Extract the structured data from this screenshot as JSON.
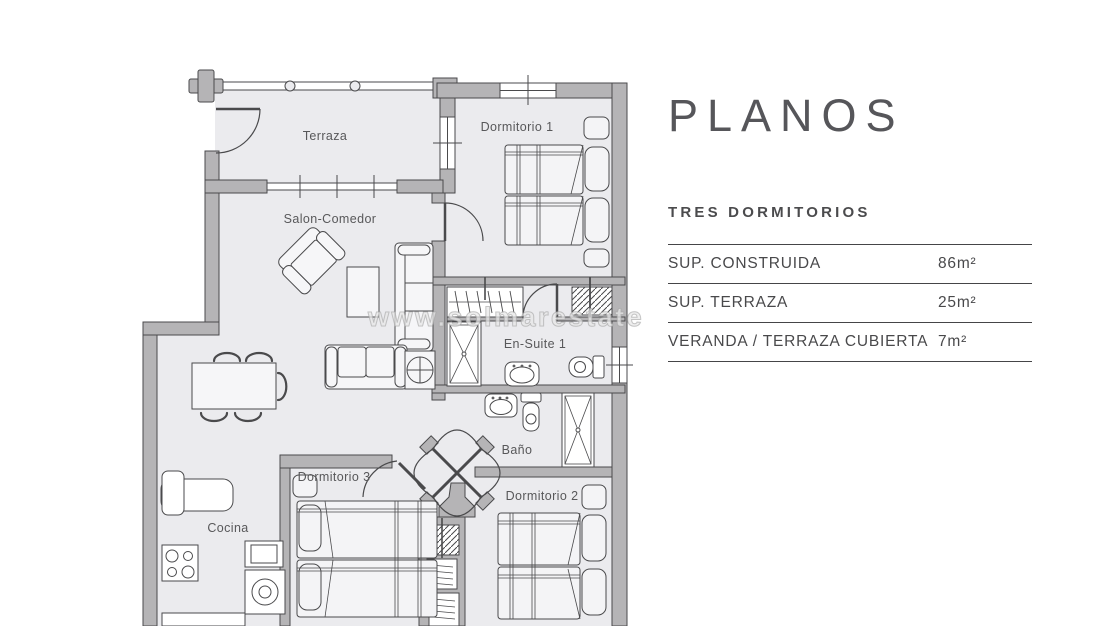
{
  "panel": {
    "title": "PLANOS",
    "subtitle": "TRES DORMITORIOS",
    "rows": [
      {
        "label": "SUP.  CONSTRUIDA",
        "value": "86m²"
      },
      {
        "label": "SUP. TERRAZA",
        "value": "25m²"
      },
      {
        "label": "VERANDA / TERRAZA CUBIERTA",
        "value": "7m²"
      }
    ]
  },
  "floorplan": {
    "watermark": "www.solmarestate",
    "rooms": {
      "terraza": "Terraza",
      "dormitorio1": "Dormitorio 1",
      "salon": "Salon-Comedor",
      "ensuite": "En-Suite 1",
      "bano": "Baño",
      "dormitorio3": "Dormitorio 3",
      "dormitorio2": "Dormitorio 2",
      "cocina": "Cocina"
    }
  },
  "colors": {
    "wall": "#b5b4b6",
    "floor": "#ebebee",
    "line": "#4a4a4c",
    "text": "#4d4d4f"
  }
}
